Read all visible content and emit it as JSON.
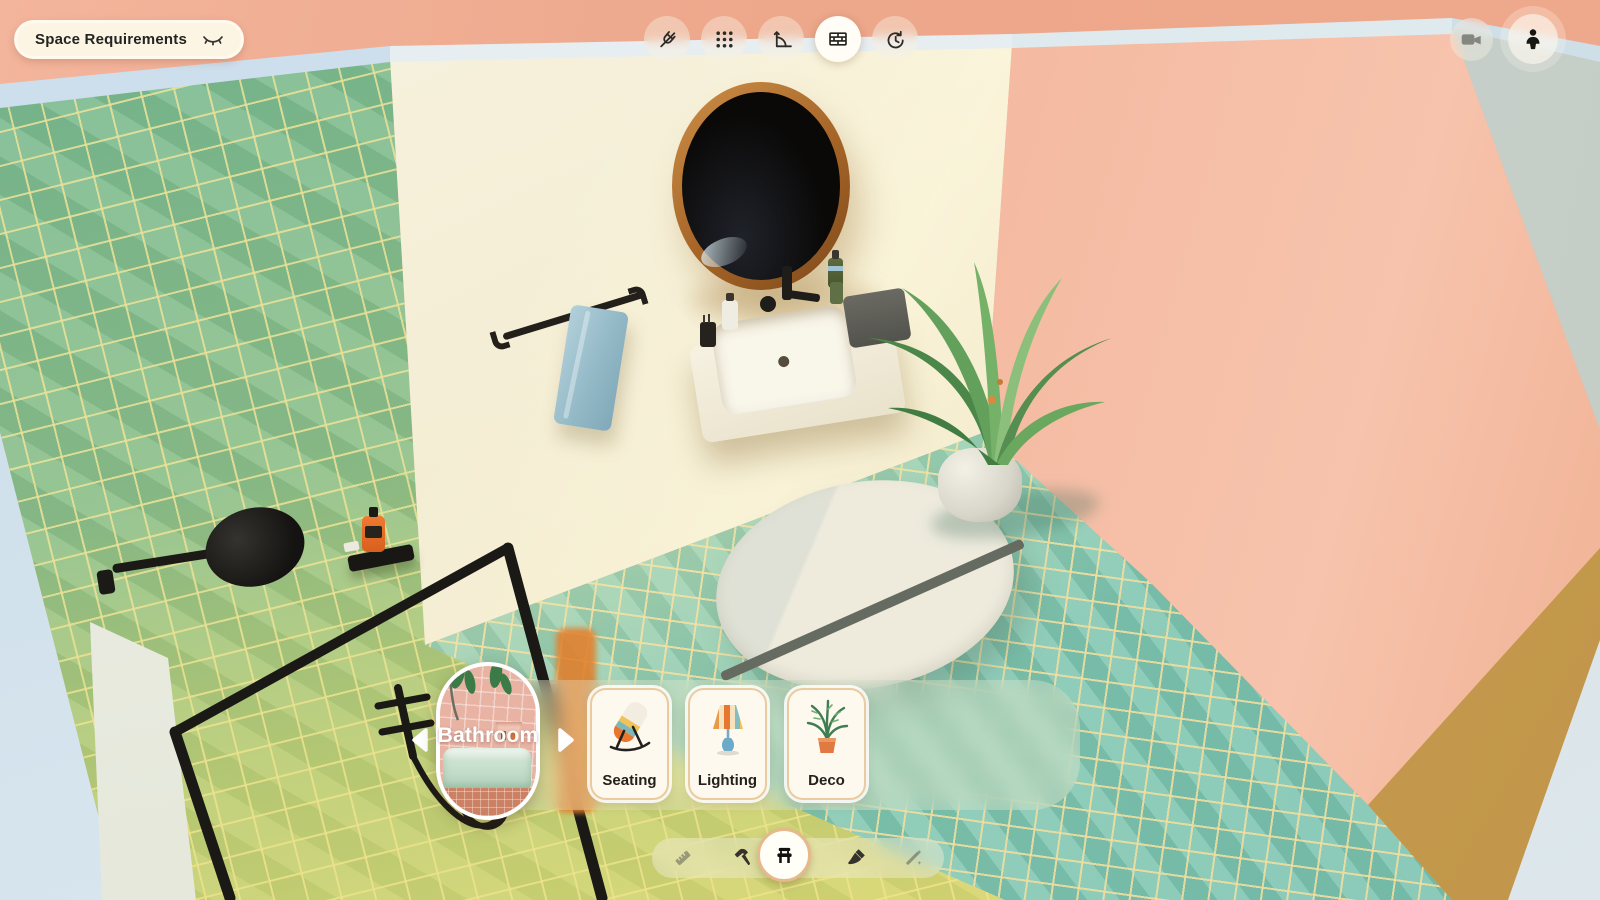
{
  "header": {
    "space_requirements_label": "Space Requirements",
    "visibility_icon": "eye-closed-icon"
  },
  "top_toolbar": {
    "buttons": [
      {
        "id": "snap",
        "icon": "magnet-off-icon",
        "selected": false
      },
      {
        "id": "grid",
        "icon": "grid-dots-icon",
        "selected": false
      },
      {
        "id": "measure-angle",
        "icon": "angle-ruler-icon",
        "selected": false
      },
      {
        "id": "walls",
        "icon": "brick-wall-icon",
        "selected": true
      },
      {
        "id": "history",
        "icon": "clock-rotate-icon",
        "selected": false
      }
    ]
  },
  "view_controls": {
    "buttons": [
      {
        "id": "camera",
        "icon": "video-camera-icon"
      },
      {
        "id": "first-person",
        "icon": "person-icon"
      }
    ]
  },
  "carousel": {
    "room_label": "Bathroom",
    "prev_icon": "chevron-left-icon",
    "next_icon": "chevron-right-icon",
    "categories": [
      {
        "label": "Seating",
        "icon": "lounge-chair-illustration"
      },
      {
        "label": "Lighting",
        "icon": "table-lamp-illustration"
      },
      {
        "label": "Deco",
        "icon": "potted-plant-illustration"
      }
    ]
  },
  "bottom_toolbar": {
    "tools": [
      {
        "id": "measure",
        "icon": "ruler-icon",
        "state": "dimmed"
      },
      {
        "id": "build",
        "icon": "hammer-icon",
        "state": "default"
      },
      {
        "id": "furniture",
        "icon": "bench-icon",
        "state": "selected"
      },
      {
        "id": "paint",
        "icon": "paintbrush-icon",
        "state": "default"
      },
      {
        "id": "effects",
        "icon": "magic-wand-icon",
        "state": "dimmed"
      }
    ]
  },
  "colors": {
    "background_salmon": "#eda58a",
    "wall_pink": "#f5bda6",
    "wall_cream": "#f4eed8",
    "wall_tile_green": "#8ec08b",
    "floor_tile_teal": "#8acbb4",
    "wall_edge_blue": "#cfe0ec",
    "ledge_mustard": "#c9a254",
    "accent_peach_border": "#ecca9f",
    "ui_cream": "#fdf6e9",
    "icon_dark": "#2b2a26"
  },
  "scene_objects": [
    "green-tile-wall",
    "cream-wall",
    "pink-wall",
    "teal-mosaic-floor",
    "round-mirror",
    "wall-faucet",
    "vanity-sink",
    "towel-rail",
    "blue-towel",
    "shower-head",
    "shower-frame",
    "hand-shower",
    "soap-dispenser-orange",
    "palm-plant",
    "plant-pot",
    "round-rug"
  ]
}
